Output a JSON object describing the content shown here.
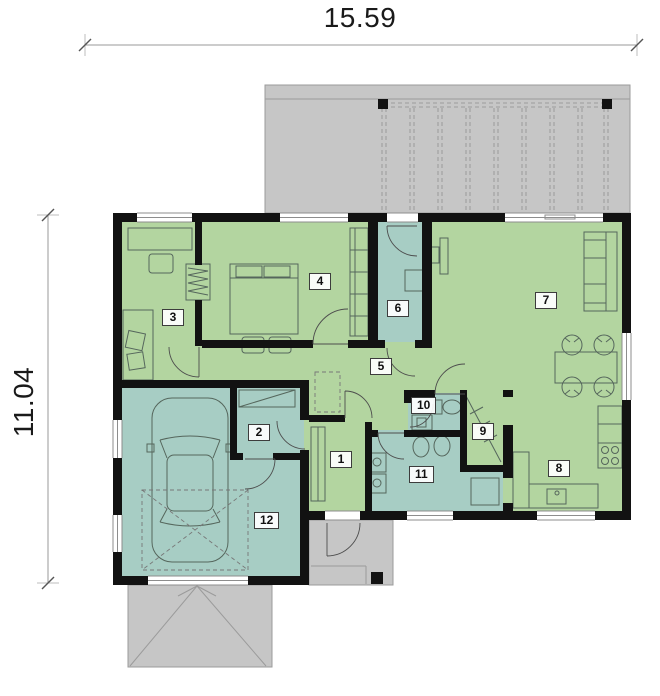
{
  "plan": {
    "dimensions": {
      "width_label": "15.59",
      "height_label": "11.04"
    },
    "colors": {
      "room_green": "#b3d5a0",
      "room_teal": "#a7cdc4",
      "outdoor_gray": "#c6c6c6",
      "outdoor_border": "#9b9b9b",
      "wall": "#121212",
      "furniture": "#55665c"
    },
    "rooms": [
      {
        "number": "1",
        "floor": "green",
        "label_x": 330,
        "label_y": 451
      },
      {
        "number": "2",
        "floor": "teal",
        "label_x": 248,
        "label_y": 424
      },
      {
        "number": "3",
        "floor": "green",
        "label_x": 162,
        "label_y": 309
      },
      {
        "number": "4",
        "floor": "green",
        "label_x": 309,
        "label_y": 273
      },
      {
        "number": "5",
        "floor": "green",
        "label_x": 370,
        "label_y": 358
      },
      {
        "number": "6",
        "floor": "teal",
        "label_x": 387,
        "label_y": 300
      },
      {
        "number": "7",
        "floor": "green",
        "label_x": 535,
        "label_y": 292
      },
      {
        "number": "8",
        "floor": "green",
        "label_x": 548,
        "label_y": 460
      },
      {
        "number": "9",
        "floor": "green",
        "label_x": 472,
        "label_y": 423
      },
      {
        "number": "10",
        "floor": "teal",
        "label_x": 411,
        "label_y": 397
      },
      {
        "number": "11",
        "floor": "teal",
        "label_x": 409,
        "label_y": 466
      },
      {
        "number": "12",
        "floor": "teal",
        "label_x": 254,
        "label_y": 512
      }
    ]
  }
}
